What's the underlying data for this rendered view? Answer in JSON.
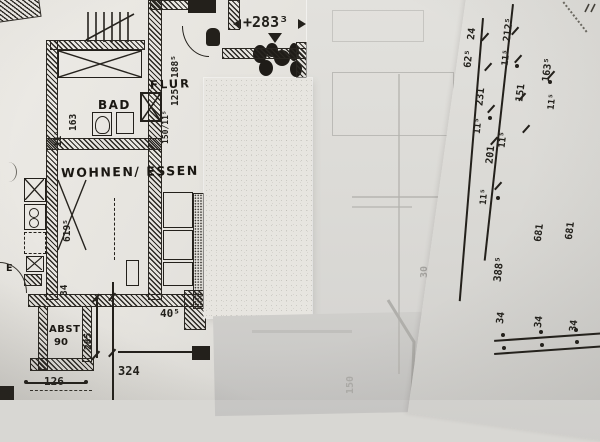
{
  "plan": {
    "rooms": {
      "flur": "FLUR",
      "bad": "BAD",
      "wohnen": "WOHNEN/ ESSEN",
      "abst": "ABST",
      "abst_num": "90",
      "e": "E"
    },
    "dims": {
      "elev": "+283³",
      "d188": "188⁵",
      "d125": "125",
      "win": "150/11⁵",
      "d163": "163",
      "d115": "11⁵",
      "d619": "619⁵",
      "d34": "34",
      "d285": "285",
      "d405": "40⁵",
      "d126": "126",
      "d324": "324"
    }
  },
  "right_sheet": {
    "chain_a": [
      "24",
      "62⁵",
      "231",
      "11⁵",
      "201",
      "11⁵",
      "388⁵"
    ],
    "chain_b": [
      "212⁵",
      "11⁵",
      "163⁵",
      "11⁵",
      "151",
      "11⁵",
      "681",
      "681"
    ],
    "bottom": [
      "34",
      "34",
      "34"
    ]
  },
  "ghost": {
    "d30": "30",
    "d150": "150"
  }
}
